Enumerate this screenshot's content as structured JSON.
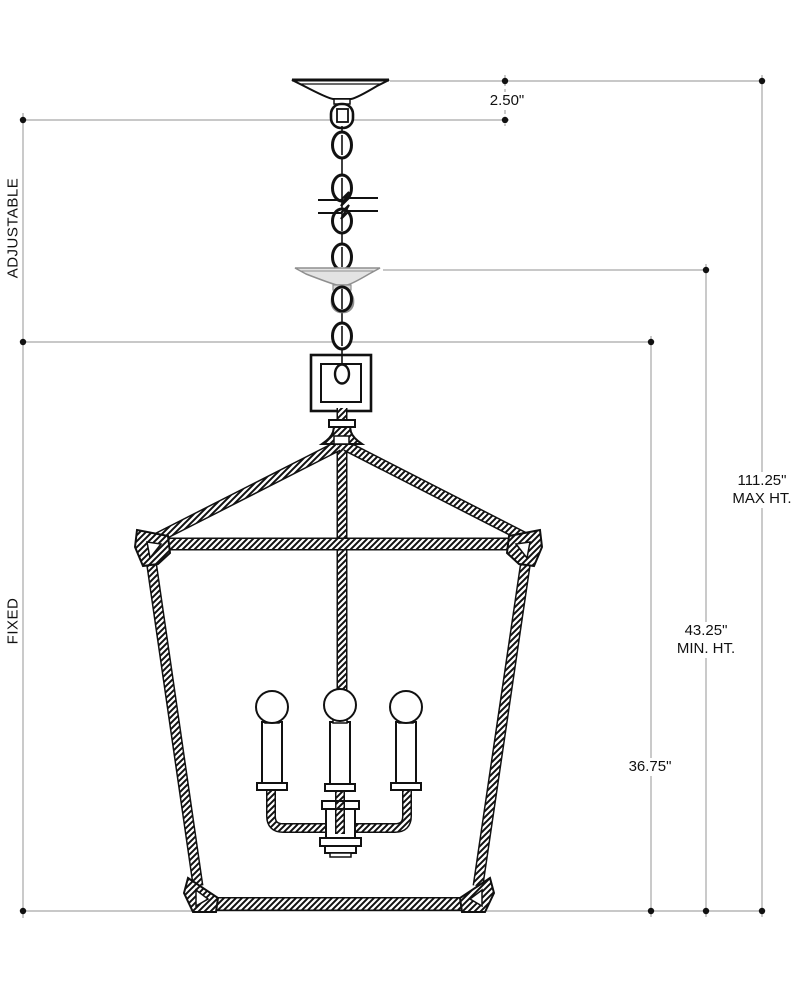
{
  "diagram": {
    "side_labels": {
      "adjustable": "ADJUSTABLE",
      "fixed": "FIXED"
    },
    "dimensions": {
      "canopy_drop": "2.50\"",
      "max_height_value": "111.25\"",
      "max_height_caption": "MAX HT.",
      "min_height_value": "43.25\"",
      "min_height_caption": "MIN. HT.",
      "lantern_height": "36.75\""
    },
    "colors": {
      "ink": "#111111",
      "dimension_line": "#a6a6a6",
      "ghost_canopy": "#8f8f8f",
      "background": "#ffffff"
    }
  }
}
